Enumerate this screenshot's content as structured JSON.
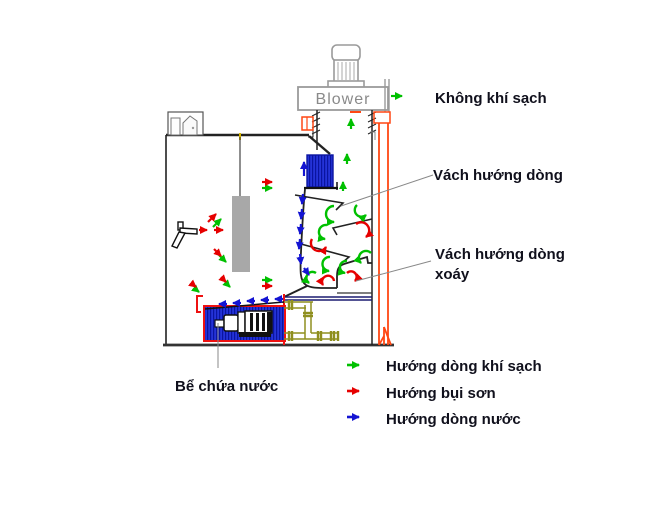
{
  "diagram": {
    "blower_label": "Blower",
    "callouts": {
      "clean_air": "Không khí sạch",
      "flow_baffle": "Vách hướng dòng",
      "vortex_baffle_line1": "Vách hướng dòng",
      "vortex_baffle_line2": "xoáy",
      "water_tank": "Bể chứa nước"
    },
    "legend": {
      "items": [
        {
          "icon": "right-arrow-icon",
          "color": "#00c000",
          "label": "Hướng dòng khí sạch"
        },
        {
          "icon": "right-arrow-icon",
          "color": "#e60000",
          "label": "Hướng bụi sơn"
        },
        {
          "icon": "right-arrow-icon",
          "color": "#1414d2",
          "label": "Hướng dòng nước"
        }
      ]
    },
    "colors": {
      "clean_air": "#00c000",
      "paint_dust": "#e60000",
      "water": "#1414d2",
      "structure_orange": "#ff4713",
      "pipe_olive": "#8f8f1f",
      "water_fill": "#2433d8",
      "tank_outline": "#ee1111",
      "blower_gray": "#9a9a9a"
    }
  }
}
